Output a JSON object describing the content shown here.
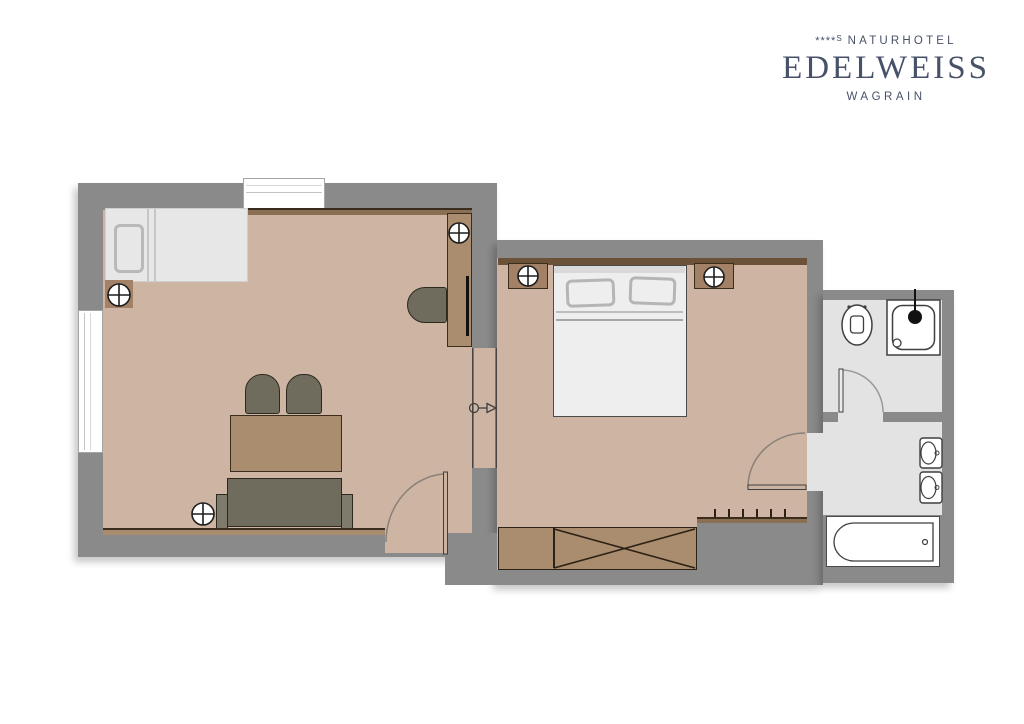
{
  "logo": {
    "stars": "****",
    "star_suffix": "S",
    "hotel_type": "NATURHOTEL",
    "name": "EDELWEISS",
    "location": "WAGRAIN"
  },
  "colors": {
    "wall": "#8a8a8a",
    "floor_wood": "#cdb4a3",
    "floor_bath": "#e3e3e3",
    "wood": "#aa8c6f",
    "wood_dark": "#a28166",
    "dark_furn": "#6f6c5e",
    "dark_furn_light": "#7e7b6c",
    "trim": "#3a2d1d",
    "bed_light": "#e7e7e7",
    "outline": "#3f3f3f",
    "swing": "#8b8178",
    "shelf": "#8a6f52",
    "logo_color": "#475168"
  },
  "icons": {
    "outlet-symbol-icon": "circle-cross",
    "door-swing": "quarter-arc",
    "passage-direction-icon": "circle-line-triangle",
    "shower-head-icon": "filled-dot"
  }
}
